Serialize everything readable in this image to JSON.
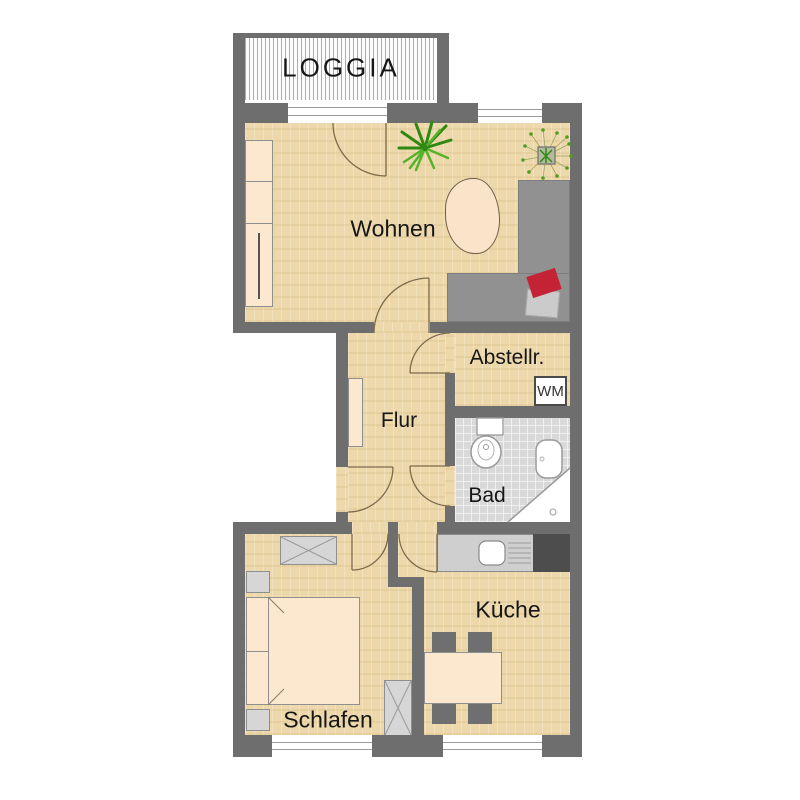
{
  "floorplan": {
    "rooms": {
      "loggia": "LOGGIA",
      "living": "Wohnen",
      "storage": "Abstellr.",
      "hall": "Flur",
      "bath": "Bad",
      "kitchen": "Küche",
      "bedroom": "Schlafen"
    },
    "appliances": {
      "washing_machine": "WM"
    },
    "colors": {
      "wall": "#6e6e6e",
      "wood_floor": "#ecd8aa",
      "tile_floor": "#d9d9d9",
      "furniture_cream": "#fbe8cf",
      "sofa_gray": "#919191",
      "pillow_red": "#c42336",
      "plant_green": "#3c9a1c"
    }
  }
}
